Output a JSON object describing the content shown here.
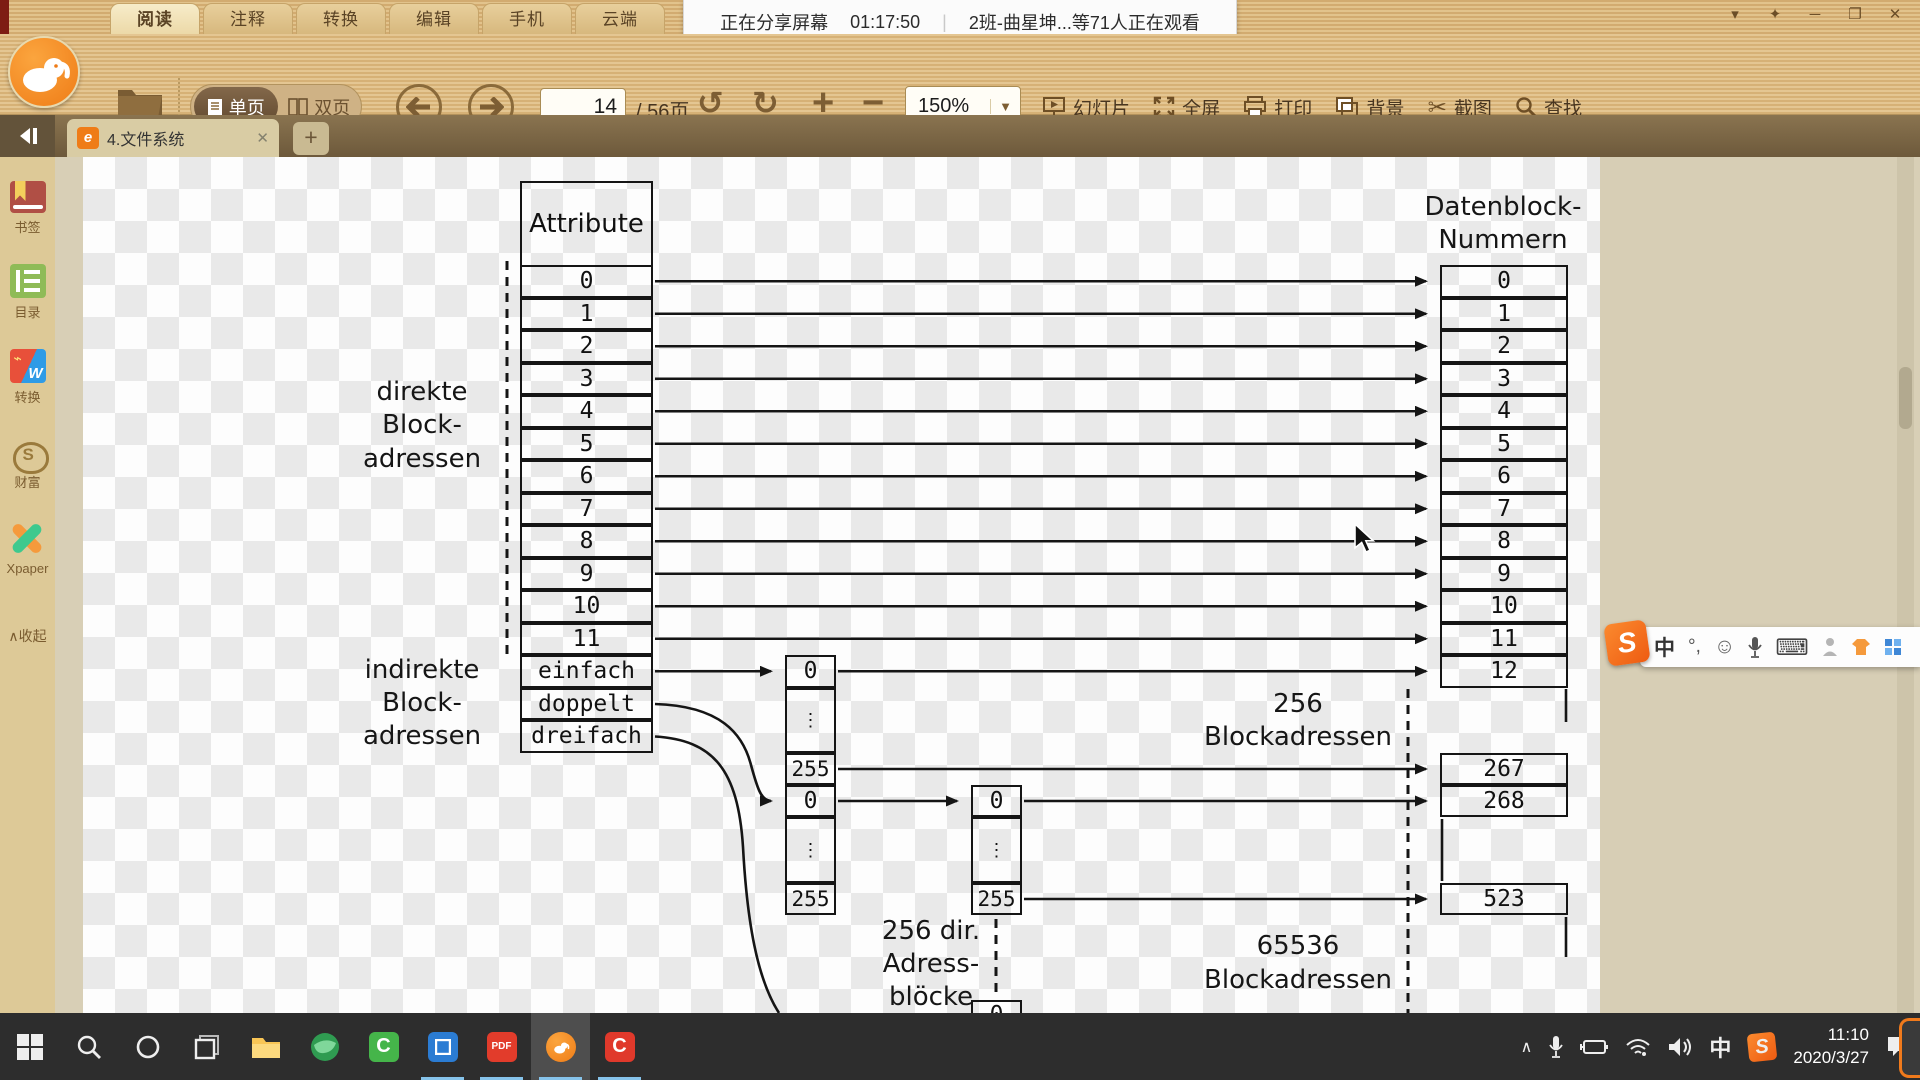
{
  "titlebar": {
    "menu_tabs": [
      "阅读",
      "注释",
      "转换",
      "编辑",
      "手机",
      "云端"
    ],
    "active_menu_tab": "阅读",
    "sharing": {
      "status": "正在分享屏幕",
      "elapsed": "01:17:50",
      "divider": "|",
      "viewers": "2班-曲星坤...等71人正在观看"
    },
    "window_controls": {
      "menu": "▾",
      "skin": "✦",
      "minimize": "─",
      "maximize": "❐",
      "close": "✕"
    }
  },
  "toolbar": {
    "view_single": "单页",
    "view_double": "双页",
    "page_current": "14",
    "page_total_suffix": "/ 56页",
    "undo": "↺",
    "redo": "↻",
    "zoom_in": "+",
    "zoom_out": "−",
    "zoom_level": "150%",
    "zoom_dropdown": "▼",
    "buttons": [
      {
        "label": "幻灯片"
      },
      {
        "label": "全屏"
      },
      {
        "label": "打印"
      },
      {
        "label": "背景"
      },
      {
        "label": "截图"
      },
      {
        "label": "查找"
      }
    ],
    "screenshot_glyph": "✂"
  },
  "sidebar": {
    "items": [
      {
        "label": "书签"
      },
      {
        "label": "目录"
      },
      {
        "label": "转换"
      },
      {
        "label": "财富"
      },
      {
        "label": "Xpaper"
      }
    ],
    "collapse_arrow": "∧",
    "collapse": "收起"
  },
  "tabbar": {
    "doc_title": "4.文件系统",
    "doc_icon": "e",
    "close": "✕",
    "new_tab": "+"
  },
  "diagram": {
    "attribute_header": "Attribute",
    "direct_rows": [
      "0",
      "1",
      "2",
      "3",
      "4",
      "5",
      "6",
      "7",
      "8",
      "9",
      "10",
      "11"
    ],
    "indirect_rows": [
      "einfach",
      "doppelt",
      "dreifach"
    ],
    "label_direct": [
      "direkte",
      "Block-",
      "adressen"
    ],
    "label_indirect": [
      "indirekte",
      "Block-",
      "adressen"
    ],
    "right_header": [
      "Datenblock-",
      "Nummern"
    ],
    "right_rows": [
      "0",
      "1",
      "2",
      "3",
      "4",
      "5",
      "6",
      "7",
      "8",
      "9",
      "10",
      "11",
      "12"
    ],
    "right_rows_mid": [
      "267",
      "268"
    ],
    "right_rows_low": [
      "523"
    ],
    "single_block": {
      "first": "0",
      "last": "255"
    },
    "double_block_l1": {
      "first": "0",
      "last": "255"
    },
    "double_block_l2": {
      "first": "0",
      "last": "255"
    },
    "partial_block_first": "0",
    "vdots": "⋮",
    "label_256": [
      "256",
      "Blockadressen"
    ],
    "label_65536": [
      "65536",
      "Blockadressen"
    ],
    "label_256dir": [
      "256 dir.",
      "Adress-",
      "blöcke"
    ]
  },
  "ime": {
    "logo": "S",
    "chinese": "中",
    "punct": "°,",
    "emoji": "☺",
    "keyboard": "⌨"
  },
  "taskbar": {
    "pdf_label": "PDF",
    "green_c_label": "C",
    "red_c_label": "C",
    "tray_expand": "∧",
    "tray_ime": "中",
    "tray_sogou": "S",
    "clock_time": "11:10",
    "clock_date": "2020/3/27"
  }
}
